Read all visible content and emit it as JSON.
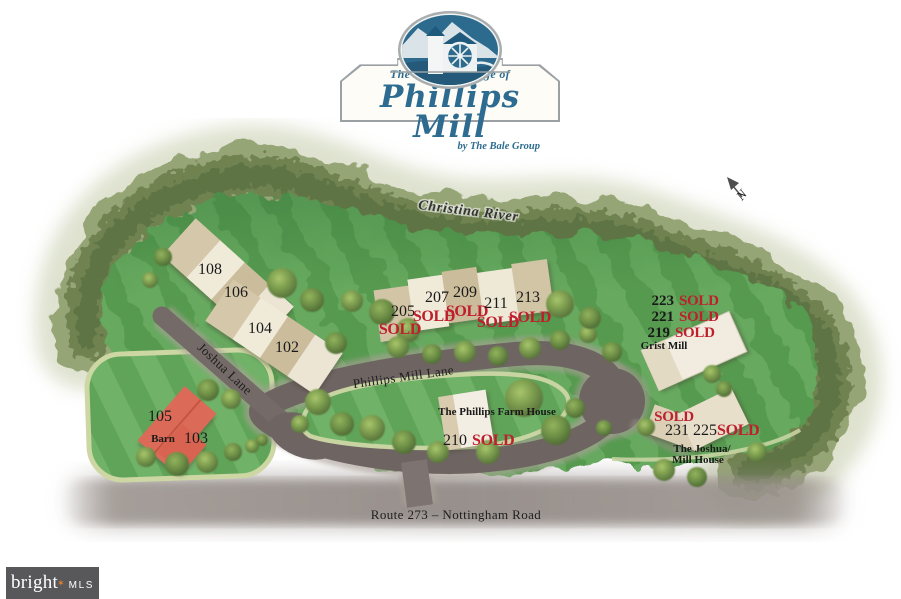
{
  "logo": {
    "tagline_top": "The Historic Village of",
    "title": "Phillips Mill",
    "byline": "by The Bale Group"
  },
  "compass": {
    "north": "N"
  },
  "river": {
    "label": "Christina River"
  },
  "roads": {
    "phillips_mill_lane": "Phillips Mill Lane",
    "joshua_lane": "Joshua Lane",
    "route_273": "Route 273 –  Nottingham Road"
  },
  "landmarks": {
    "grist_mill": "Grist Mill",
    "farm_house": "The Phillips Farm House",
    "joshua_mill_house_line1": "The Joshua/",
    "joshua_mill_house_line2": "Mill House",
    "barn": "Barn"
  },
  "lots": [
    {
      "number": "108"
    },
    {
      "number": "106"
    },
    {
      "number": "104"
    },
    {
      "number": "102"
    },
    {
      "number": "205",
      "sold_label": "SOLD"
    },
    {
      "number": "207",
      "sold_label": "SOLD"
    },
    {
      "number": "209",
      "sold_label": "SOLD"
    },
    {
      "number": "211",
      "sold_label": "SOLD"
    },
    {
      "number": "213",
      "sold_label": "SOLD"
    },
    {
      "number": "223",
      "sold_label": "SOLD"
    },
    {
      "number": "221",
      "sold_label": "SOLD"
    },
    {
      "number": "219",
      "sold_label": "SOLD"
    },
    {
      "number": "210",
      "sold_label": "SOLD"
    },
    {
      "number": "231",
      "sold_label": "SOLD"
    },
    {
      "number": "225",
      "sold_label": "SOLD"
    },
    {
      "number": "105"
    },
    {
      "number": "103"
    }
  ],
  "watermark": {
    "brand": "bright",
    "star": "✶",
    "suffix": "MLS"
  },
  "colors": {
    "sold_red": "#bf1f2d",
    "logo_teal": "#2d6c90",
    "road_gray": "#6e6462",
    "lawn_green": "#5a9c53",
    "forest_green": "#7d8f5f",
    "barn_red": "#dc6a58",
    "watermark_bg": "#58585a",
    "star_orange": "#e08133"
  }
}
